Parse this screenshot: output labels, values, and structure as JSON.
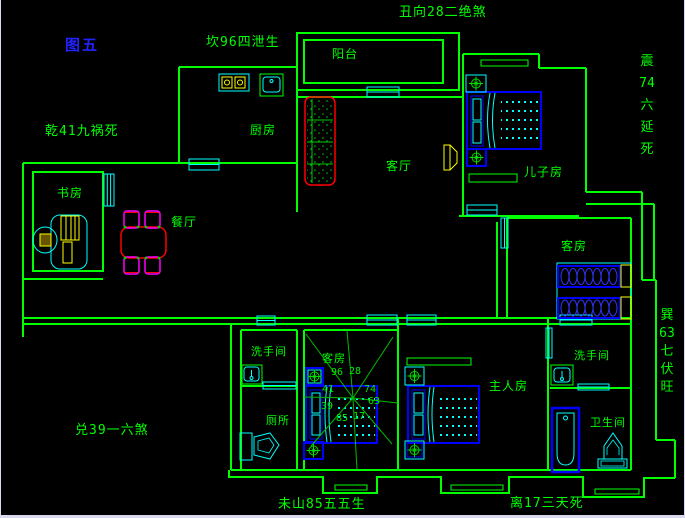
{
  "title": {
    "figure_label": "图五"
  },
  "fengshui": {
    "north": "坎96四泄生",
    "northeast_facing": "丑向28二绝煞",
    "northwest": "乾41九祸死",
    "west": "兑39一六煞",
    "south_mountain": "未山85五五生",
    "south": "离17三天死",
    "east": {
      "text": "震74六延死",
      "lines": [
        "震",
        "74",
        "六",
        "延",
        "死"
      ]
    },
    "southeast": {
      "text": "巽63七伏旺",
      "lines": [
        "巽",
        "63",
        "七",
        "伏",
        "旺"
      ]
    }
  },
  "rooms": {
    "balcony": "阳台",
    "kitchen": "厨房",
    "living_room": "客厅",
    "sons_room": "儿子房",
    "study": "书房",
    "dining_room": "餐厅",
    "guest_room_east": "客房",
    "guest_room_middle": "客房",
    "washroom_west": "洗手间",
    "toilet": "厕所",
    "master_room": "主人房",
    "washroom_east": "洗手间",
    "bathroom": "卫生间"
  },
  "compass": {
    "n_left": "96",
    "n_right": "28",
    "nw": "41",
    "ne": "74",
    "w": "39",
    "e": "63",
    "sw": "85",
    "se": "17"
  },
  "colors": {
    "background": "#000000",
    "wall": "#00ff00",
    "window_door": "#00ffff",
    "furniture": "#0000ff",
    "accent": "#ffff00",
    "sofa_table": "#ff0000",
    "chair": "#ff00ff",
    "figure_label": "#2222ff"
  }
}
